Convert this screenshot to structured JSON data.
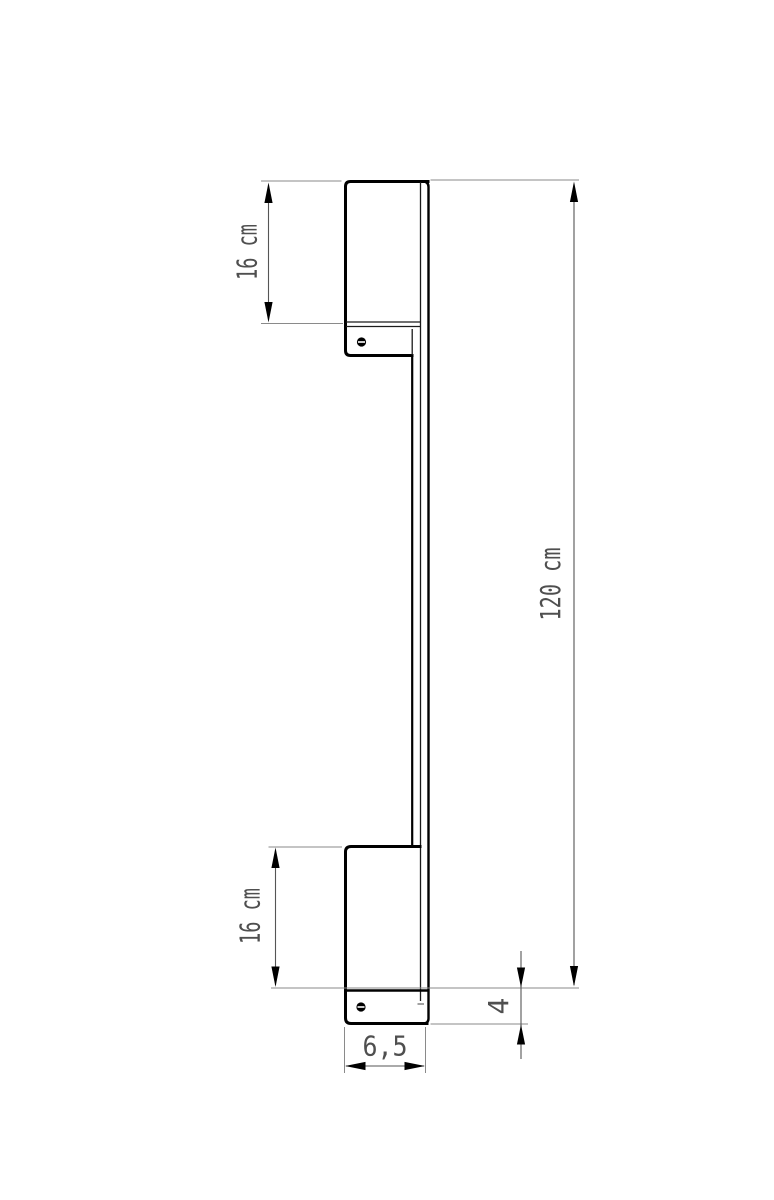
{
  "drawing": {
    "kind": "technical-dimension-drawing",
    "subject": "linear wall lamp, side profile",
    "labels": {
      "top_bracket_height": "16 cm",
      "overall_height": "120 cm",
      "bottom_bracket_height": "16 cm",
      "end_cap_height": "4",
      "base_width": "6,5"
    },
    "colors": {
      "outline": "#000000",
      "dimension_line": "#555555",
      "extension_line": "#8a8a8a",
      "arrow": "#000000",
      "label_text": "#4f4f4f",
      "paper": "#ffffff"
    }
  }
}
